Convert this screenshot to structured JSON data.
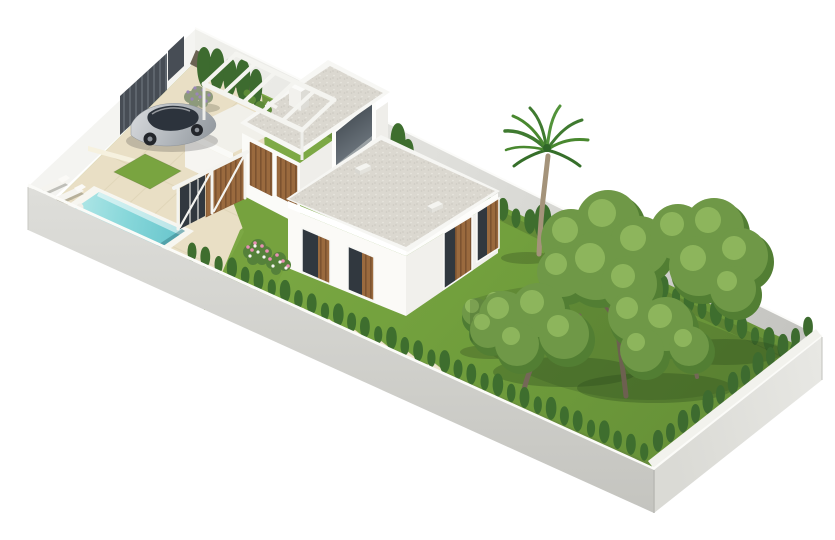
{
  "window": {
    "width": 835,
    "height": 540
  },
  "scene": {
    "type": "3d-architectural-render",
    "subject": "isometric rendering of a modern two-storey villa plot with swimming pool, driveway, parked car and landscaped garden inside a white perimeter wall",
    "objects": [
      "perimeter-wall",
      "entrance-gate",
      "driveway-paving",
      "parked-car",
      "swimming-pool",
      "sun-loungers",
      "stepping-stones",
      "lawn",
      "villa",
      "garage",
      "tower",
      "roof-pergola",
      "entrance-pergola",
      "wood-slat-windows",
      "roof-skylights",
      "chimney",
      "palm-tree",
      "garden-trees",
      "olive-bush",
      "cypress-hedge",
      "lavender-bush",
      "flower-bed"
    ]
  },
  "palette": {
    "background": "#ffffff",
    "wall_white": "#f4f4f1",
    "wall_outer": "#cfcfca",
    "wall_inner_shadow": "#c6c6c2",
    "paving": "#e9dfc5",
    "paving_line": "#d9cdae",
    "curb": "#f6f1df",
    "grass": "#76a23e",
    "grass_light": "#83ad4a",
    "grass_dark": "#527e33",
    "lawn": "#79a440",
    "soil": "#6b6353",
    "hedge": "#3e6e2e",
    "cypress": "#3d6b2f",
    "canopy_dark": "#527e33",
    "canopy_mid": "#6f9847",
    "canopy_light": "#91b95f",
    "trunk": "#746757",
    "pool_coping": "#f7f6f0",
    "water_light": "#b5e8e8",
    "water_deep": "#66c4cb",
    "wood": "#9a6a3e",
    "wood_dark": "#7c5330",
    "gravel": "#dbd8d0",
    "fascia": "#ffffff",
    "glass": "#31383f",
    "gate_slat": "#474d55",
    "car_silver": "#c2c6ca",
    "car_glass": "#2c333c",
    "lavender": "#8d9a7b",
    "flower_pink": "#e78fb3",
    "flower_white": "#f6f6f2",
    "lounger": "#f5f4ef"
  }
}
